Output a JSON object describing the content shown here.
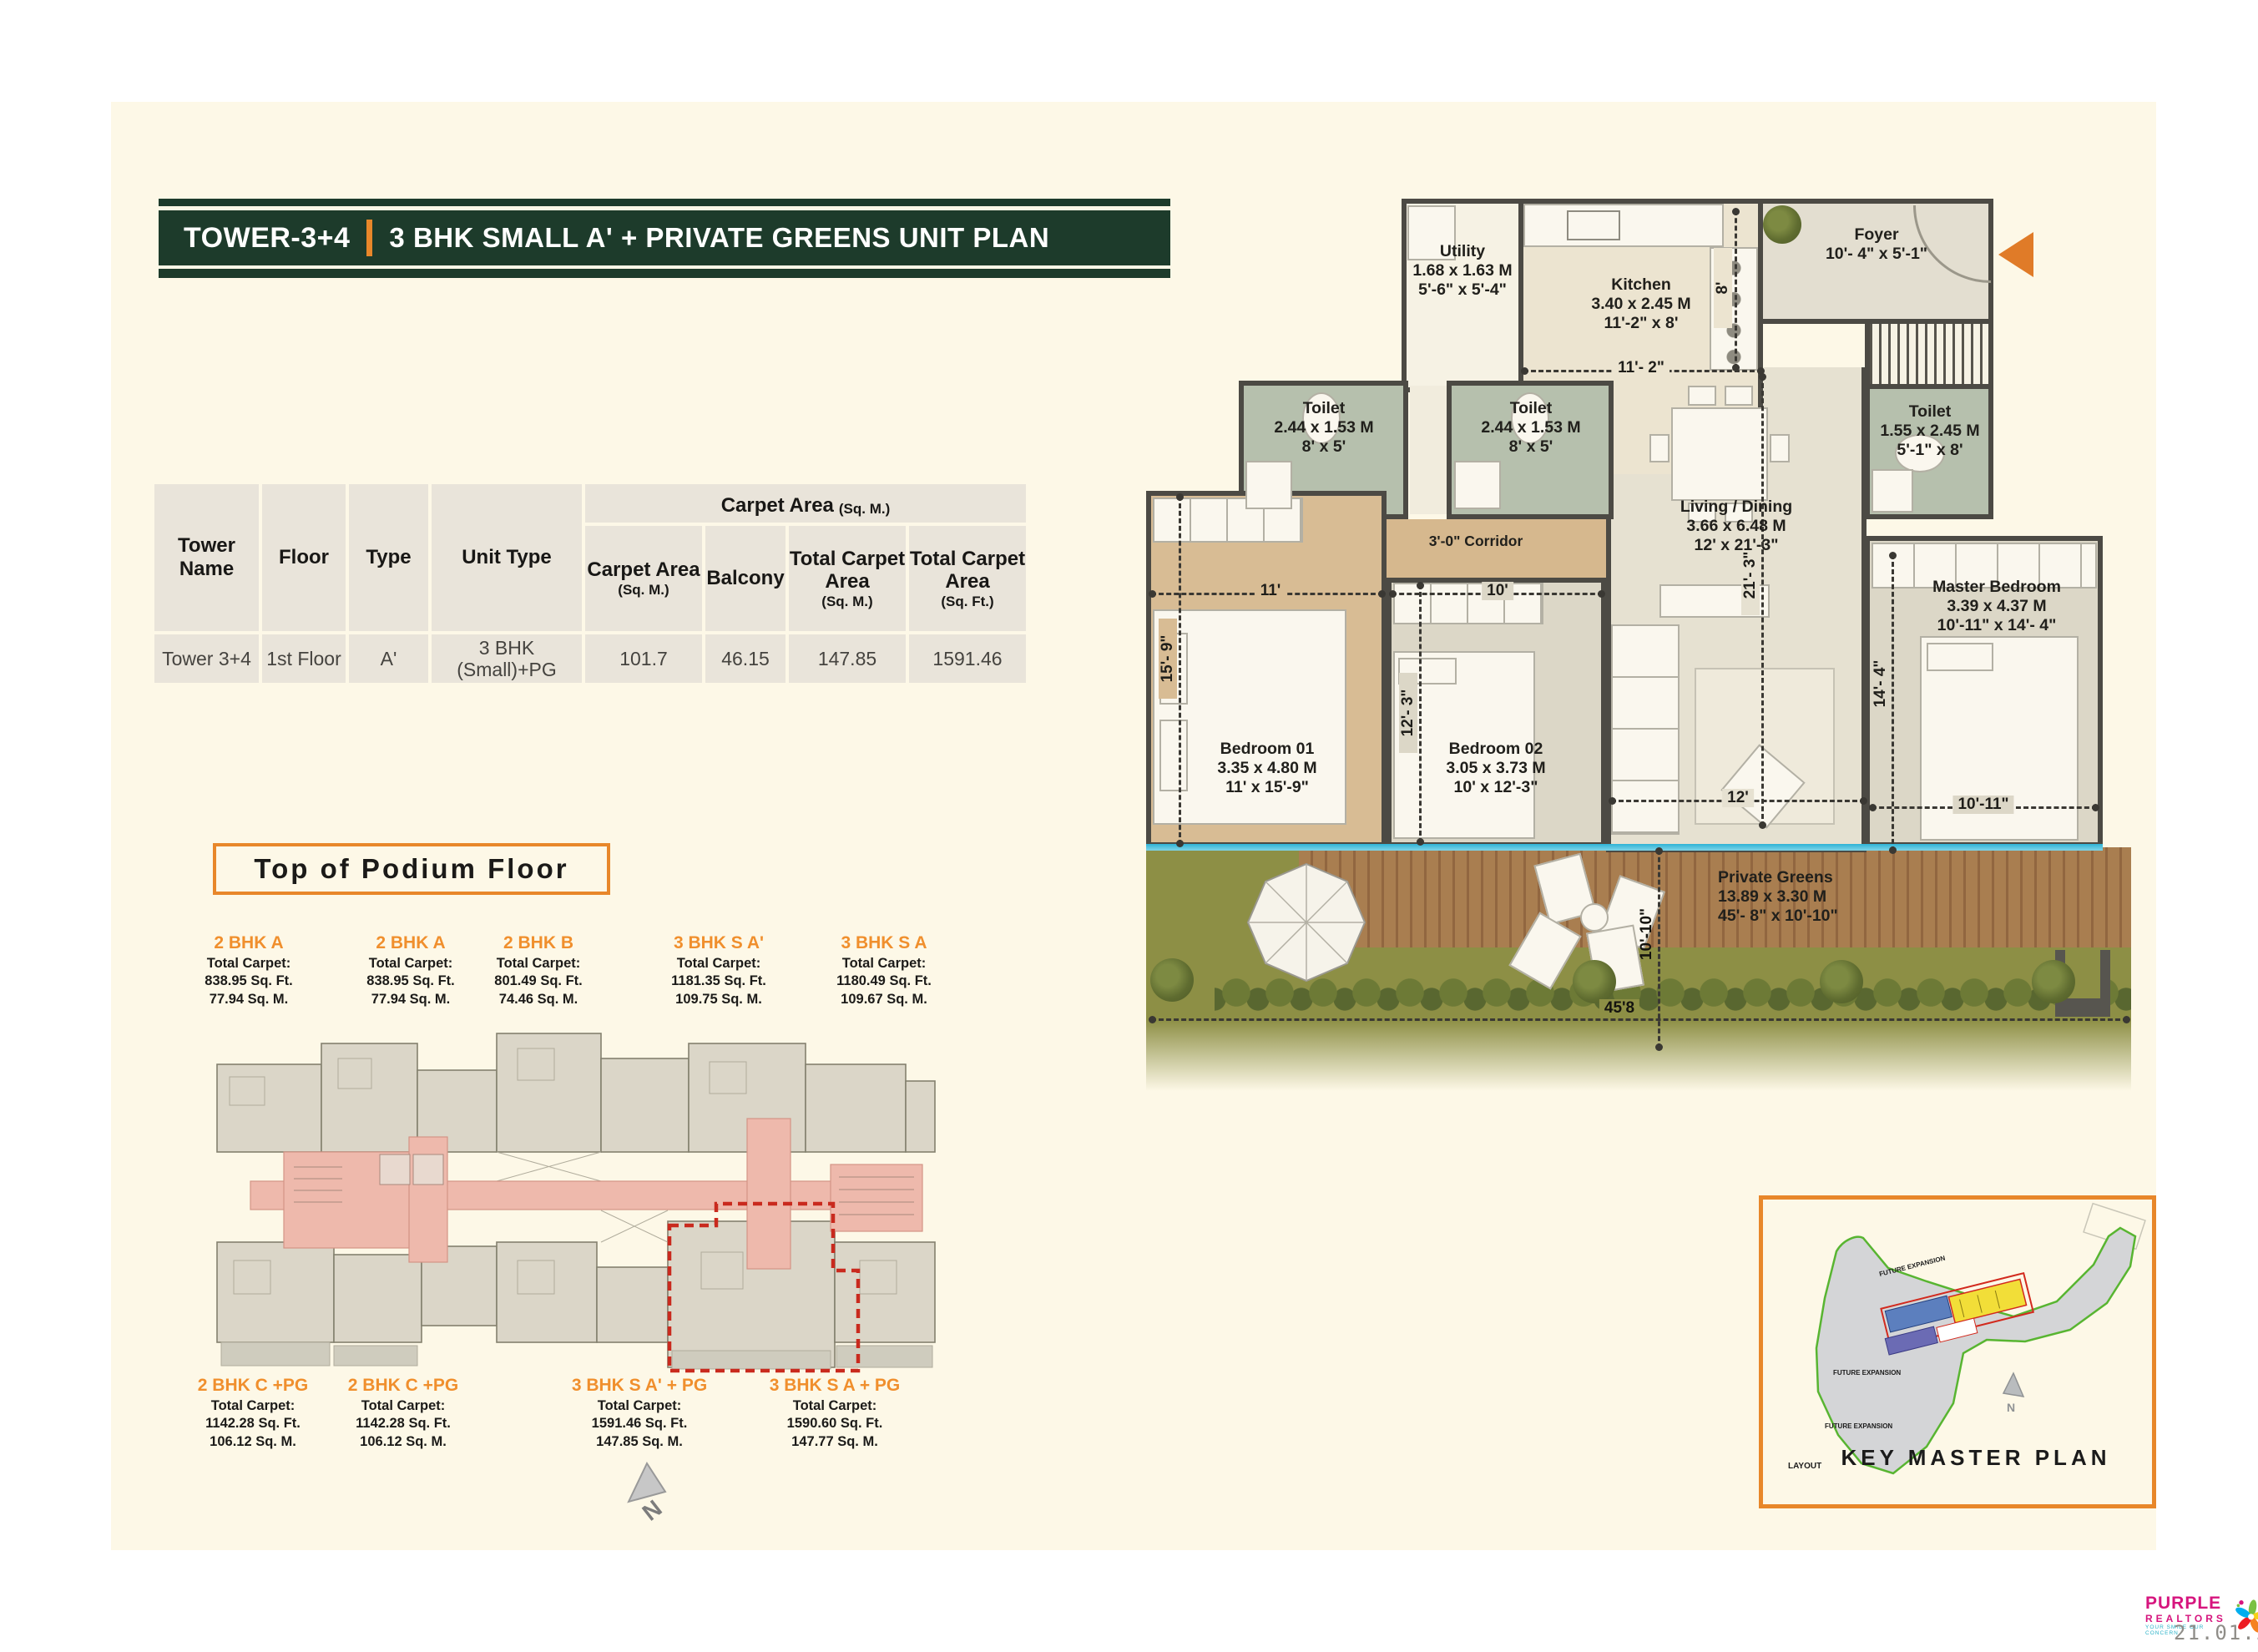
{
  "banner": {
    "tower_label": "TOWER-3+4",
    "plan_title": "3 BHK SMALL A' + PRIVATE GREENS UNIT PLAN"
  },
  "table": {
    "group_header": "Carpet Area",
    "group_header_unit": "(Sq. M.)",
    "headers": {
      "tower": "Tower Name",
      "floor": "Floor",
      "type": "Type",
      "unit_type": "Unit Type",
      "carpet": "Carpet Area",
      "carpet_unit": "(Sq. M.)",
      "balcony": "Balcony",
      "total_m": "Total Carpet Area",
      "total_m_unit": "(Sq. M.)",
      "total_ft": "Total Carpet Area",
      "total_ft_unit": "(Sq. Ft.)"
    },
    "row": {
      "tower": "Tower 3+4",
      "floor": "1st Floor",
      "type": "A'",
      "unit_type": "3 BHK (Small)+PG",
      "carpet": "101.7",
      "balcony": "46.15",
      "total_m": "147.85",
      "total_ft": "1591.46"
    }
  },
  "podium": {
    "heading": "Top of Podium Floor",
    "north_label": "N",
    "top_units": [
      {
        "name": "2 BHK A",
        "total": "Total Carpet:",
        "sqft": "838.95 Sq. Ft.",
        "sqm": "77.94 Sq. M."
      },
      {
        "name": "2 BHK A",
        "total": "Total Carpet:",
        "sqft": "838.95 Sq. Ft.",
        "sqm": "77.94 Sq. M."
      },
      {
        "name": "2 BHK B",
        "total": "Total Carpet:",
        "sqft": "801.49 Sq. Ft.",
        "sqm": "74.46 Sq. M."
      },
      {
        "name": "3 BHK S A'",
        "total": "Total Carpet:",
        "sqft": "1181.35 Sq. Ft.",
        "sqm": "109.75 Sq. M."
      },
      {
        "name": "3 BHK S A",
        "total": "Total Carpet:",
        "sqft": "1180.49 Sq. Ft.",
        "sqm": "109.67 Sq. M."
      }
    ],
    "bottom_units": [
      {
        "name": "2 BHK C +PG",
        "total": "Total Carpet:",
        "sqft": "1142.28 Sq. Ft.",
        "sqm": "106.12 Sq. M."
      },
      {
        "name": "2 BHK C +PG",
        "total": "Total Carpet:",
        "sqft": "1142.28 Sq. Ft.",
        "sqm": "106.12 Sq. M."
      },
      {
        "name": "3 BHK S A' + PG",
        "total": "Total Carpet:",
        "sqft": "1591.46 Sq. Ft.",
        "sqm": "147.85 Sq. M."
      },
      {
        "name": "3 BHK S A + PG",
        "total": "Total Carpet:",
        "sqft": "1590.60 Sq. Ft.",
        "sqm": "147.77 Sq. M."
      }
    ]
  },
  "plan": {
    "rooms": {
      "utility": {
        "name": "Utility",
        "m": "1.68 x 1.63 M",
        "ft": "5'-6\" x 5'-4\""
      },
      "kitchen": {
        "name": "Kitchen",
        "m": "3.40 x 2.45 M",
        "ft": "11'-2\" x 8'"
      },
      "foyer": {
        "name": "Foyer",
        "ft": "10'- 4\" x 5'-1\""
      },
      "toilet1": {
        "name": "Toilet",
        "m": "2.44 x 1.53 M",
        "ft": "8' x 5'"
      },
      "toilet2": {
        "name": "Toilet",
        "m": "2.44 x 1.53 M",
        "ft": "8' x 5'"
      },
      "toilet3": {
        "name": "Toilet",
        "m": "1.55 x 2.45 M",
        "ft": "5'-1\" x 8'"
      },
      "corridor": {
        "name": "3'-0\" Corridor"
      },
      "living": {
        "name": "Living / Dining",
        "m": "3.66 x 6.48 M",
        "ft": "12' x 21'-3\""
      },
      "bedroom1": {
        "name": "Bedroom 01",
        "m": "3.35 x 4.80 M",
        "ft": "11' x 15'-9\""
      },
      "bedroom2": {
        "name": "Bedroom 02",
        "m": "3.05 x 3.73 M",
        "ft": "10' x 12'-3\""
      },
      "master": {
        "name": "Master Bedroom",
        "m": "3.39 x 4.37 M",
        "ft": "10'-11\" x 14'- 4\""
      },
      "greens": {
        "name": "Private Greens",
        "m": "13.89 x 3.30 M",
        "ft": "45'- 8\" x 10'-10\""
      }
    },
    "dims": {
      "d11_2": "11'- 2\"",
      "d8": "8'",
      "d11": "11'",
      "d10": "10'",
      "d12": "12'",
      "d15_9": "15'- 9\"",
      "d12_3": "12'- 3\"",
      "d21_3": "21'- 3\"",
      "d14_4": "14'- 4\"",
      "d10_11": "10'-11\"",
      "d10_10": "10'-10\"",
      "d45_8": "45'8"
    }
  },
  "key_plan": {
    "title": "KEY MASTER PLAN",
    "future1": "FUTURE EXPANSION",
    "future2": "FUTURE EXPANSION",
    "future3": "FUTURE EXPANSION",
    "layout": "LAYOUT",
    "north_label": "N"
  },
  "footer": {
    "brand_line1": "PURPLE",
    "brand_line2": "REALTORS",
    "tagline": "YOUR SMILE OUR CONCERN",
    "date": "21.01.2026"
  },
  "colors": {
    "accent_orange": "#e8872a",
    "banner_green": "#1d3b2b",
    "highlight_pink": "#eeb9ac",
    "dashed_red": "#c92a1e",
    "toilet_green": "#b6c0ad",
    "grass_olive": "#8d8f45"
  }
}
